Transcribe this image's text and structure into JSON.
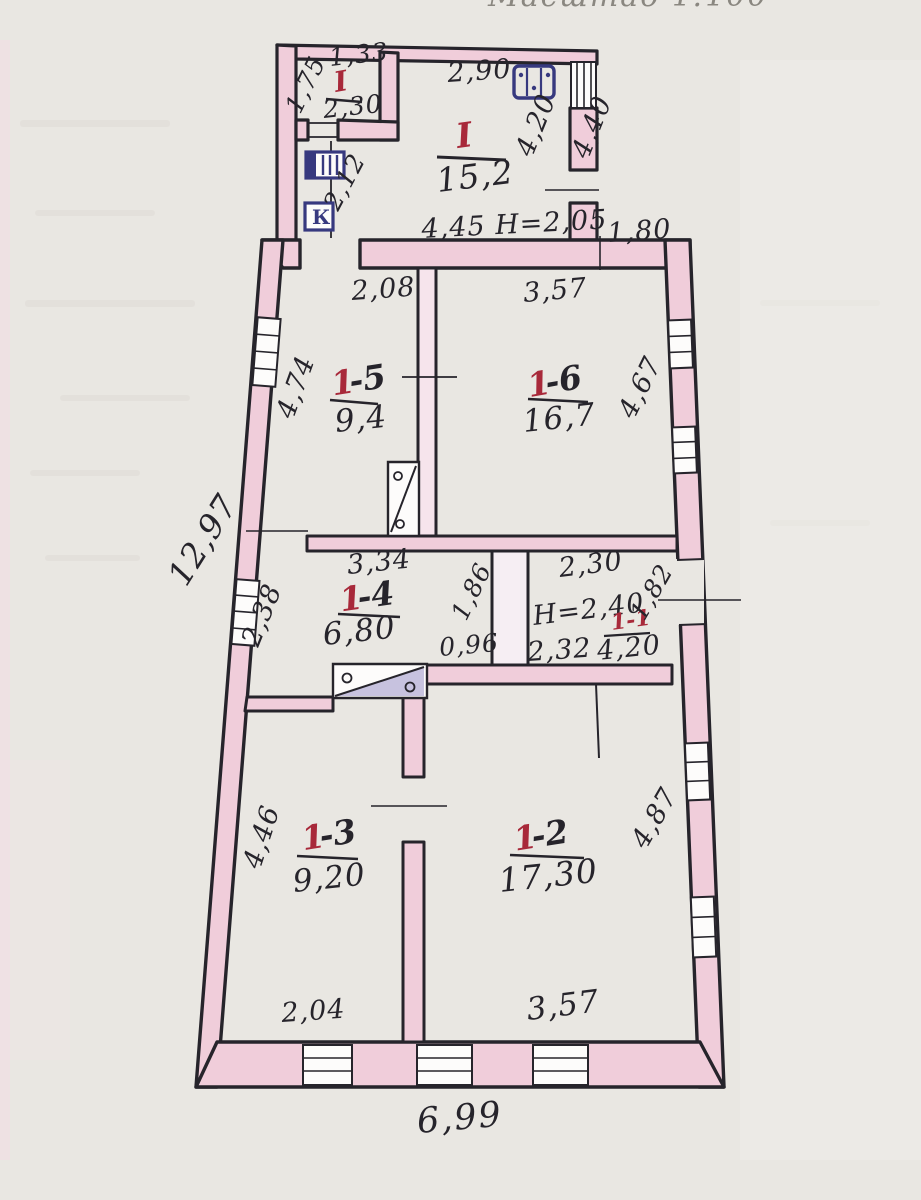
{
  "page": {
    "scale_fragment": "Масштаб 1:100"
  },
  "outer": {
    "left": "12,97",
    "bottom": "6,99"
  },
  "annex": {
    "room_main": {
      "label": "I",
      "area": "15,2",
      "dim_top": "2,90",
      "dim_right": "4,20",
      "dim_bottom": "4,45 Н=2,05"
    },
    "room_small": {
      "label": "I",
      "area": "2,30",
      "dim_top": "1,33",
      "dim_left": "1,75"
    },
    "dim_below_small": "2,12",
    "outer_right": "4,40",
    "wall_right_top": "1,80",
    "k_mark": "К"
  },
  "rooms": {
    "r15": {
      "num_red": "1",
      "num_black": "-5",
      "area": "9,4",
      "dim_top": "2,08",
      "dim_left": "4,74"
    },
    "r16": {
      "num_red": "1",
      "num_black": "-6",
      "area": "16,7",
      "dim_top": "3,57",
      "dim_right": "4,67"
    },
    "r14": {
      "num_red": "1",
      "num_black": "-4",
      "area": "6,80",
      "dim_top": "3,34",
      "dim_left": "2,38",
      "dim_right": "1,86",
      "dim_bottom": "0,96"
    },
    "hall": {
      "height": "Н=2,40",
      "label": "1-1",
      "area": "4,20",
      "dim_top": "2,30",
      "dim_right": "1,82",
      "dim_bottom": "2,32"
    },
    "r13": {
      "num_red": "1",
      "num_black": "-3",
      "area": "9,20",
      "dim_left": "4,46",
      "dim_bottom": "2,04"
    },
    "r12": {
      "num_red": "1",
      "num_black": "-2",
      "area": "17,30",
      "dim_right": "4,87",
      "dim_bottom": "3,57"
    }
  },
  "colors": {
    "ink": "#26242b",
    "wall_pink": "#f0cdda",
    "red": "#a8293a",
    "blue": "#37397f",
    "purple": "#8d86c0",
    "paper": "#e9e7e2"
  }
}
